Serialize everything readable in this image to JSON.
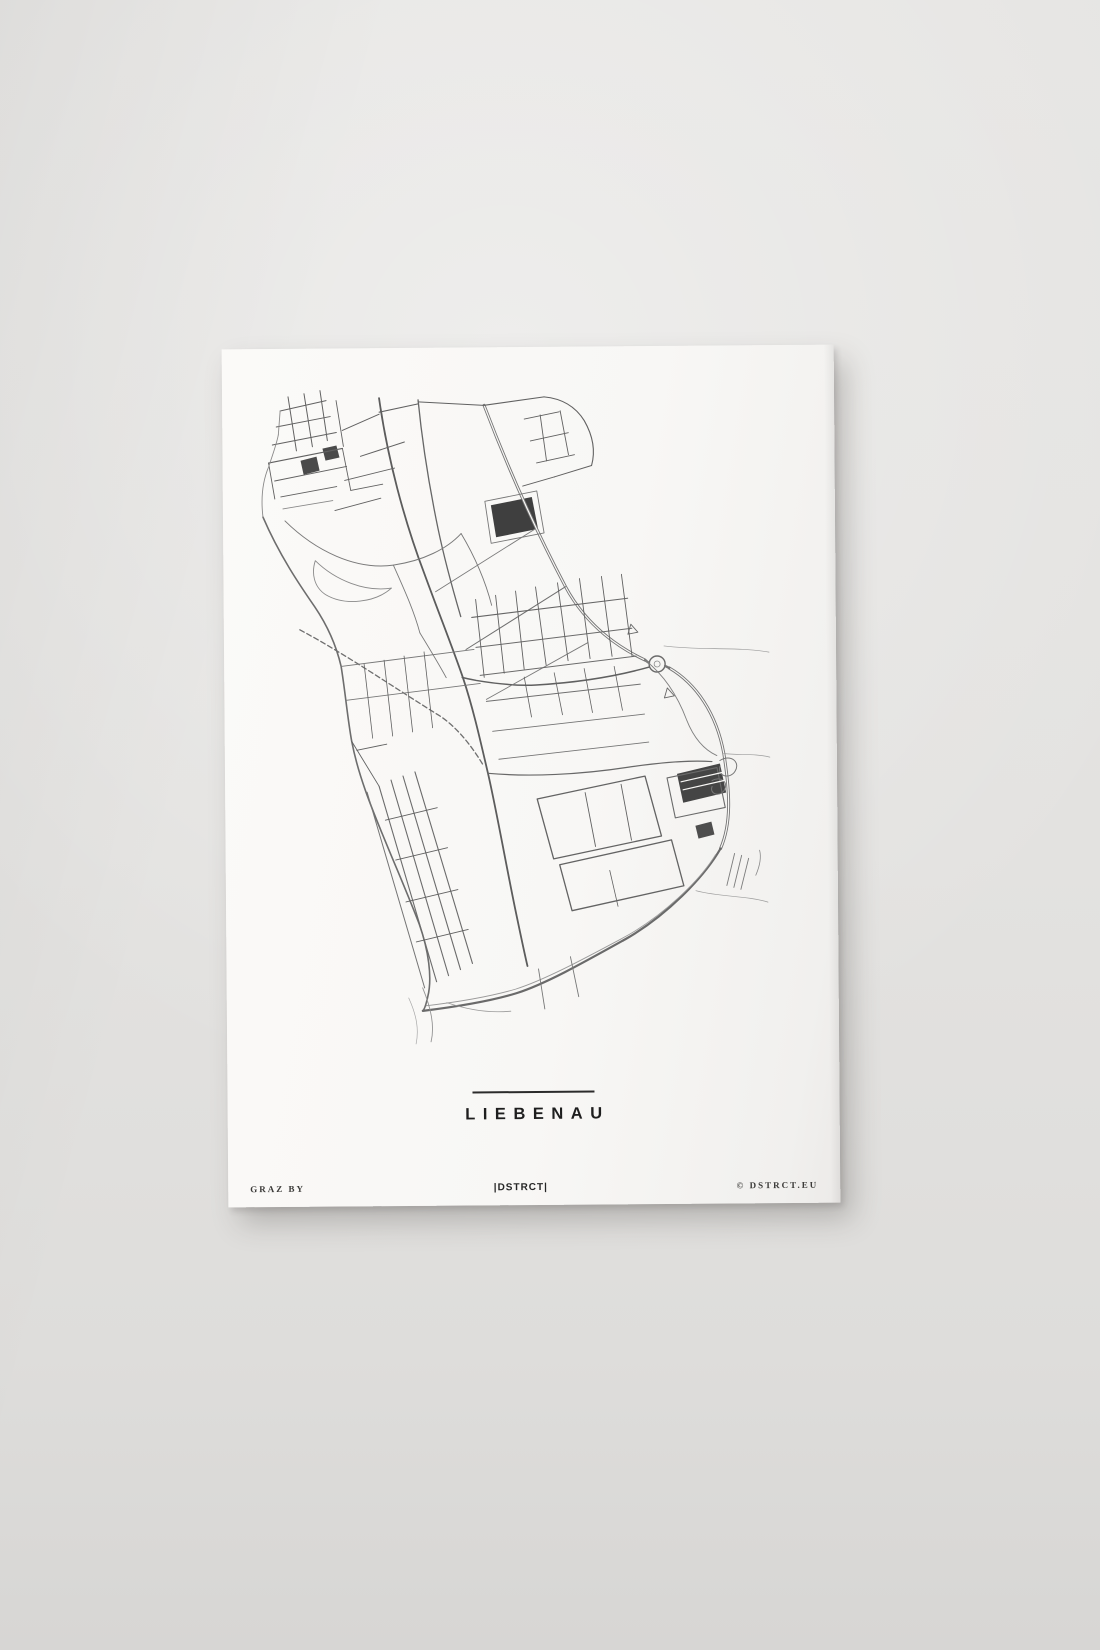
{
  "poster": {
    "title": "LIEBENAU",
    "footer_left": "GRAZ BY",
    "footer_center": "|DSTRCT|",
    "footer_right": "© DSTRCT.EU"
  },
  "colors": {
    "wall": "#e3e2e0",
    "paper": "#f8f7f5",
    "ink_dark": "#1e1e1e",
    "road_default": "#616161",
    "fill_dark": "#3f3f3f"
  },
  "map": {
    "region_label": "Liebenau street network",
    "fills": [
      {
        "d": "M268,158 L309,150 L315,182 L273,190 Z",
        "c": "#3f3f3f"
      },
      {
        "d": "M452,428 L495,418 L501,447 L458,457 Z",
        "c": "#454545"
      },
      {
        "d": "M78,112 L94,108 L97,122 L81,126 Z",
        "c": "#4a4a4a"
      },
      {
        "d": "M100,100 L114,97 L117,109 L103,112 Z",
        "c": "#4a4a4a"
      },
      {
        "d": "M470,480 L486,476 L489,489 L473,493 Z",
        "c": "#4e4e4e"
      }
    ],
    "roads": [
      {
        "d": "M262,58 C285,120 312,182 342,240 C362,278 392,300 421,314",
        "w": 3,
        "c": "#757575"
      },
      {
        "d": "M262,58 C285,120 312,182 342,240 C362,278 392,300 421,314",
        "w": 1.2,
        "c": "#f8f7f5"
      },
      {
        "d": "M445,322 C472,338 492,368 499,408 C505,448 506,478 495,503",
        "w": 3,
        "c": "#757575"
      },
      {
        "d": "M445,322 C472,338 492,368 499,408 C505,448 506,478 495,503",
        "w": 1.2,
        "c": "#f8f7f5"
      },
      {
        "d": "M495,503 C478,532 440,570 399,593 C357,616 319,637 290,646 C260,655 222,660 196,663",
        "w": 2.2,
        "c": "#6a6a6a"
      },
      {
        "d": "M490,509 C474,535 436,571 396,592 C356,613 318,633 289,642 C261,650 226,655 199,658",
        "w": 0.9,
        "c": "#9a9a9a"
      },
      {
        "d": "M40,168 C56,206 76,236 91,258 C105,279 113,300 117,318 C121,344 123,370 127,393 C133,426 146,459 159,491 C171,521 183,549 193,576 C202,602 206,630 201,649 C199,658 197,662 196,663",
        "w": 1.6,
        "c": "#6d6d6d"
      },
      {
        "d": "M157,50 C165,110 181,172 201,226 C216,268 229,301 239,331 C249,362 256,395 263,426 C271,462 281,521 289,561 C294,586 298,606 301,619",
        "w": 1.8,
        "c": "#5c5c5c"
      },
      {
        "d": "M196,52 C200,96 207,141 215,181 C221,211 229,241 237,269",
        "w": 1.3,
        "c": "#666666"
      },
      {
        "d": "M433,318 m-8,0 a8,8 0 1,0 16,0 a8,8 0 1,0 -16,0",
        "w": 1.4,
        "c": "#6a6a6a"
      },
      {
        "d": "M433,318 m-3,0 a3,3 0 1,0 6,0 a3,3 0 1,0 -6,0",
        "w": 0.8,
        "c": "#8a8a8a"
      },
      {
        "d": "M421,314 L425,317",
        "w": 2.4,
        "c": "#757575"
      },
      {
        "d": "M441,320 L445,322",
        "w": 2.4,
        "c": "#757575"
      },
      {
        "d": "M425,321 C392,330 352,336 312,338 C291,339 269,336 252,333 C247,332 242,331 238,330",
        "w": 1.5,
        "c": "#606060"
      },
      {
        "d": "M495,415 c11,-7 21,2 15,11 c-5,8 -18,5 -15,-5",
        "w": 1,
        "c": "#777777"
      },
      {
        "d": "M487,435 c9,-5 17,2 12,10 c-5,7 -15,3 -12,-4",
        "w": 1,
        "c": "#777777"
      },
      {
        "d": "M407,278 l7,8 l-10,2 z",
        "w": 0.9,
        "c": "#666666"
      },
      {
        "d": "M443,342 l7,8 l-10,2 z",
        "w": 0.9,
        "c": "#666666"
      },
      {
        "d": "M76,281 C122,306 172,341 215,368 C233,380 248,400 259,419",
        "w": 1.3,
        "c": "#6e6e6e",
        "dash": "5,3"
      },
      {
        "d": "M58,62 L104,52",
        "w": 1
      },
      {
        "d": "M54,78 L108,68",
        "w": 1
      },
      {
        "d": "M50,96 L114,84",
        "w": 1.1
      },
      {
        "d": "M46,114 L120,100",
        "w": 1.1
      },
      {
        "d": "M52,132 L124,118",
        "w": 1
      },
      {
        "d": "M58,148 L114,138",
        "w": 0.9
      },
      {
        "d": "M66,48 L74,102",
        "w": 1
      },
      {
        "d": "M82,45 L90,98",
        "w": 1
      },
      {
        "d": "M98,42 L105,92",
        "w": 1
      },
      {
        "d": "M114,52 L121,98",
        "w": 0.9
      },
      {
        "d": "M46,114 L52,150",
        "w": 0.9
      },
      {
        "d": "M120,100 L128,142",
        "w": 0.9
      },
      {
        "d": "M128,142 L160,136",
        "w": 0.9
      },
      {
        "d": "M60,160 L110,152",
        "w": 0.8,
        "c": "#888888"
      },
      {
        "d": "M56,86 L58,62",
        "w": 0.9,
        "c": "#8a8a8a"
      },
      {
        "d": "M40,168 C38,150 40,132 46,118 C50,106 54,96 56,86",
        "w": 0.9,
        "c": "#8a8a8a"
      },
      {
        "d": "M120,82 L157,66",
        "w": 1
      },
      {
        "d": "M138,108 L182,94",
        "w": 1
      },
      {
        "d": "M122,132 L172,120",
        "w": 0.9
      },
      {
        "d": "M112,162 L158,150",
        "w": 0.9
      },
      {
        "d": "M157,64 L196,56",
        "w": 1.1
      },
      {
        "d": "M196,54 L262,58",
        "w": 1
      },
      {
        "d": "M62,172 C92,202 132,222 170,217 C200,213 224,201 238,186",
        "w": 1,
        "c": "#7a7a7a"
      },
      {
        "d": "M92,212 C112,232 142,244 168,240 C152,254 122,258 102,246 C90,238 88,224 92,212",
        "w": 0.9,
        "c": "#8a8a8a"
      },
      {
        "d": "M170,217 C180,240 190,262 196,285",
        "w": 0.9,
        "c": "#7a7a7a"
      },
      {
        "d": "M196,285 C205,300 214,315 222,330",
        "w": 0.9,
        "c": "#7a7a7a"
      },
      {
        "d": "M262,58 L322,50",
        "w": 1.1
      },
      {
        "d": "M322,50 C342,52 354,61 362,74 C371,90 373,105 369,119",
        "w": 1.1
      },
      {
        "d": "M369,119 L332,130",
        "w": 1
      },
      {
        "d": "M332,130 L300,139",
        "w": 1
      },
      {
        "d": "M302,72 L337,65",
        "w": 0.9
      },
      {
        "d": "M308,94 L346,86",
        "w": 0.9
      },
      {
        "d": "M314,116 L352,108",
        "w": 0.9
      },
      {
        "d": "M318,68 L324,114",
        "w": 0.9
      },
      {
        "d": "M338,64 L346,108",
        "w": 0.9
      },
      {
        "d": "M262,154 L314,144 L321,186 L268,196 Z",
        "w": 0.9,
        "c": "#777777"
      },
      {
        "d": "M342,240 L242,302",
        "w": 1,
        "c": "#6f6f6f"
      },
      {
        "d": "M312,182 L212,244",
        "w": 0.9,
        "c": "#7a7a7a"
      },
      {
        "d": "M364,296 L262,352",
        "w": 0.9,
        "c": "#7a7a7a"
      },
      {
        "d": "M238,186 C252,210 262,234 268,258",
        "w": 0.9,
        "c": "#777777"
      },
      {
        "d": "M248,270 L404,252",
        "w": 1.1,
        "c": "#656565"
      },
      {
        "d": "M252,300 L408,282",
        "w": 1,
        "c": "#6a6a6a"
      },
      {
        "d": "M256,328 L412,310",
        "w": 1,
        "c": "#6a6a6a"
      },
      {
        "d": "M262,354 L416,338",
        "w": 1,
        "c": "#6f6f6f"
      },
      {
        "d": "M268,384 L420,368",
        "w": 0.9,
        "c": "#747474"
      },
      {
        "d": "M274,412 L424,396",
        "w": 0.9,
        "c": "#757575"
      },
      {
        "d": "M252,252 L260,330",
        "w": 0.9
      },
      {
        "d": "M272,248 L280,326",
        "w": 0.9
      },
      {
        "d": "M292,244 L300,322",
        "w": 0.9
      },
      {
        "d": "M312,240 L322,318",
        "w": 0.9
      },
      {
        "d": "M334,236 L344,314",
        "w": 0.9
      },
      {
        "d": "M356,232 L366,312",
        "w": 0.9
      },
      {
        "d": "M378,230 L388,310",
        "w": 0.9
      },
      {
        "d": "M398,228 L408,310",
        "w": 0.9
      },
      {
        "d": "M300,330 L307,370",
        "w": 0.8
      },
      {
        "d": "M330,326 L338,368",
        "w": 0.8
      },
      {
        "d": "M360,322 L368,366",
        "w": 0.8
      },
      {
        "d": "M390,320 L398,364",
        "w": 0.8
      },
      {
        "d": "M121,352 L256,336",
        "w": 0.9,
        "c": "#787878"
      },
      {
        "d": "M117,318 L250,302",
        "w": 0.9,
        "c": "#787878"
      },
      {
        "d": "M140,316 L148,390",
        "w": 0.8
      },
      {
        "d": "M160,312 L168,388",
        "w": 0.8
      },
      {
        "d": "M180,308 L188,384",
        "w": 0.8
      },
      {
        "d": "M200,304 L208,380",
        "w": 0.8
      },
      {
        "d": "M263,426 C305,430 355,428 403,421 C432,417 462,414 487,416",
        "w": 1.2,
        "c": "#686868"
      },
      {
        "d": "M312,452 L420,430 L436,490 L328,512 Z",
        "w": 1.3,
        "c": "#636363"
      },
      {
        "d": "M334,518 L446,494 L458,540 L346,564 Z",
        "w": 1.3,
        "c": "#636363"
      },
      {
        "d": "M442,432 L492,422 L500,462 L450,472 Z",
        "w": 1.1,
        "c": "#6a6a6a"
      },
      {
        "d": "M360,446 L370,500",
        "w": 0.9
      },
      {
        "d": "M396,438 L406,494",
        "w": 0.9
      },
      {
        "d": "M384,524 L392,560",
        "w": 0.8
      },
      {
        "d": "M456,436 L497,427",
        "w": 1.2,
        "c": "#f8f7f5"
      },
      {
        "d": "M458,444 L499,435",
        "w": 1.2,
        "c": "#f8f7f5"
      },
      {
        "d": "M154,438 L210,634",
        "w": 1.1,
        "c": "#6b6b6b"
      },
      {
        "d": "M166,432 L222,628",
        "w": 1.1,
        "c": "#6b6b6b"
      },
      {
        "d": "M178,428 L234,622",
        "w": 1.1,
        "c": "#6b6b6b"
      },
      {
        "d": "M190,424 L246,616",
        "w": 1.1,
        "c": "#6b6b6b"
      },
      {
        "d": "M142,444 L198,640",
        "w": 1,
        "c": "#747474"
      },
      {
        "d": "M160,472 L212,460",
        "w": 0.9
      },
      {
        "d": "M170,512 L222,500",
        "w": 0.9
      },
      {
        "d": "M180,554 L232,542",
        "w": 0.9
      },
      {
        "d": "M190,594 L242,582",
        "w": 0.9
      },
      {
        "d": "M132,402 L162,396",
        "w": 0.9
      },
      {
        "d": "M127,393 L154,438",
        "w": 0.9
      },
      {
        "d": "M312,622 L318,662",
        "w": 0.9,
        "c": "#777777"
      },
      {
        "d": "M344,610 L352,650",
        "w": 0.9,
        "c": "#777777"
      },
      {
        "d": "M196,640 C204,660 208,678 204,694",
        "w": 0.9,
        "c": "#949494"
      },
      {
        "d": "M182,650 C190,668 192,682 189,696",
        "w": 0.7,
        "c": "#a8a8a8"
      },
      {
        "d": "M220,655 C240,662 262,666 284,664",
        "w": 0.8,
        "c": "#9a9a9a"
      },
      {
        "d": "M509,508 L501,540",
        "w": 0.9,
        "c": "#7c7c7c"
      },
      {
        "d": "M516,510 L508,542",
        "w": 0.9,
        "c": "#7c7c7c"
      },
      {
        "d": "M523,513 L515,544",
        "w": 0.9,
        "c": "#7c7c7c"
      },
      {
        "d": "M530,530 C534,521 536,513 534,505",
        "w": 0.8,
        "c": "#8a8a8a"
      },
      {
        "d": "M499,408 C515,410 530,408 545,412",
        "w": 0.7,
        "c": "#9c9c9c"
      },
      {
        "d": "M440,300 C476,305 512,301 545,307",
        "w": 0.7,
        "c": "#9c9c9c"
      },
      {
        "d": "M470,545 C496,552 520,550 542,557",
        "w": 0.7,
        "c": "#9c9c9c"
      },
      {
        "d": "M421,314 C441,330 454,352 462,374 C469,392 479,404 492,410",
        "w": 0.9,
        "c": "#808080"
      }
    ]
  }
}
